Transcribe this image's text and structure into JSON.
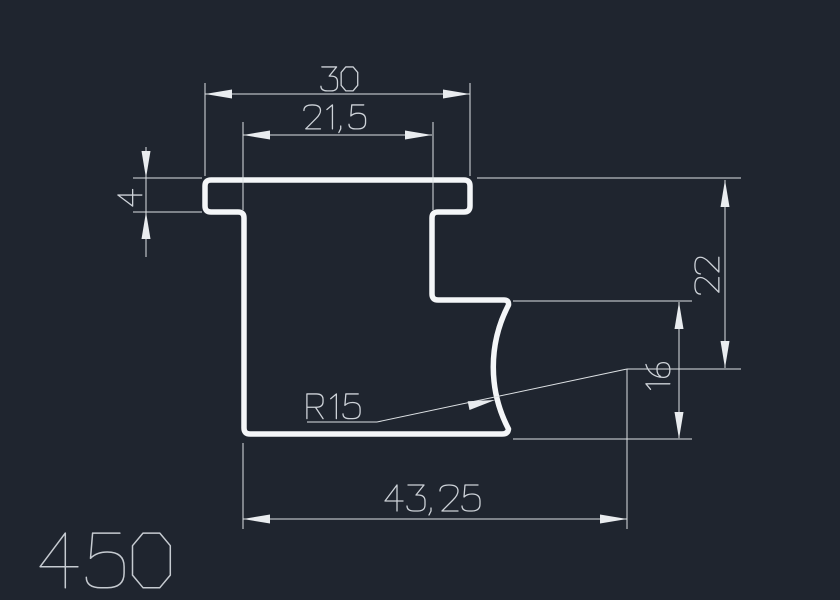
{
  "window": {
    "title": "CAD profile drawing",
    "background": "#1f252f"
  },
  "drawing": {
    "part_number": "450",
    "dimensions": {
      "top_width": "30",
      "inner_width": "21,5",
      "flange_thickness": "4",
      "right_height": "22",
      "step_height": "16",
      "corner_radius": "R15",
      "bottom_width": "43,25"
    },
    "colors": {
      "background": "#1f252f",
      "profile_outline": "#f4f6f8",
      "dimension_lines": "#dde1e4",
      "arrowheads": "#e9ecef",
      "dimension_text": "#cdd2d8",
      "part_number_text": "#c6cbd1"
    }
  }
}
